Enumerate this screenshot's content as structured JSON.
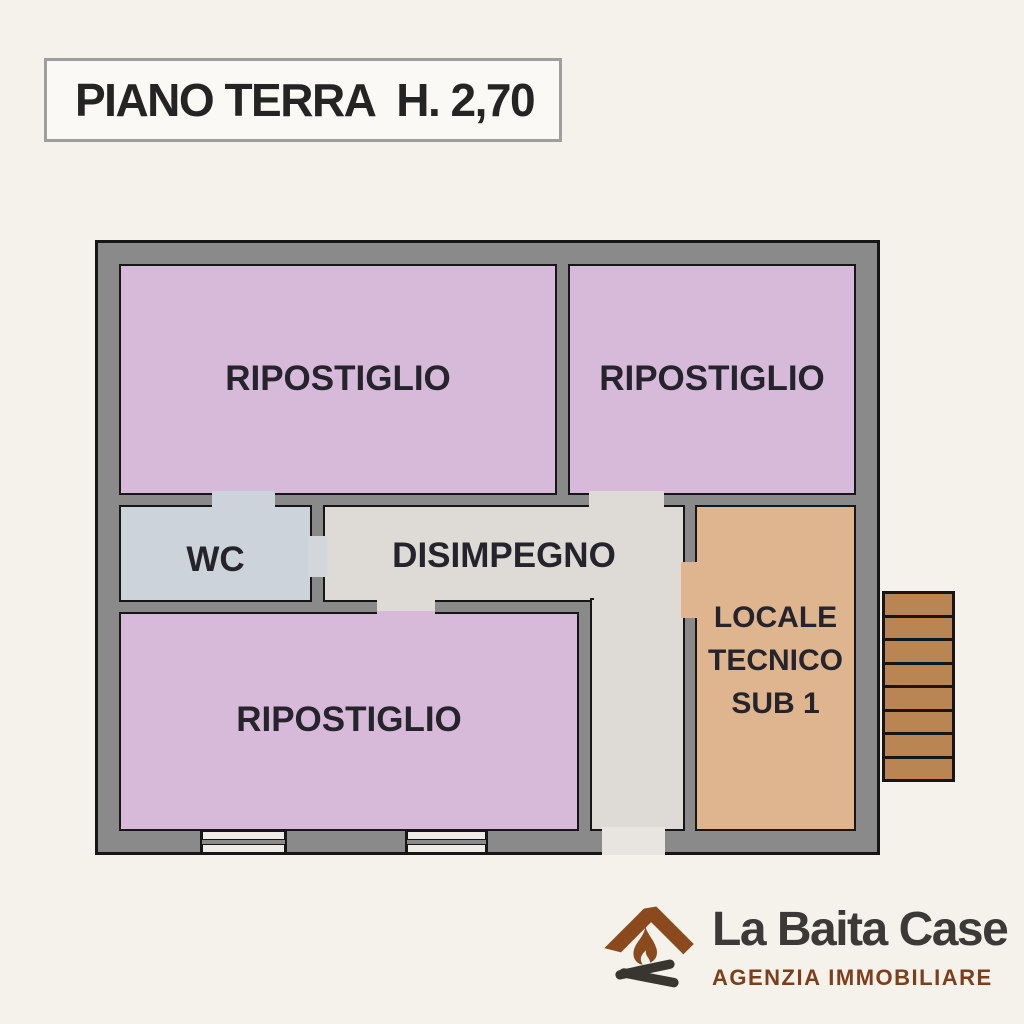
{
  "title": {
    "label": "PIANO TERRA  H. 2,70"
  },
  "rooms": {
    "storage_top_left": {
      "label": "RIPOSTIGLIO",
      "fill": "#d7b9da"
    },
    "storage_top_right": {
      "label": "RIPOSTIGLIO",
      "fill": "#d7b9da"
    },
    "wc": {
      "label": "WC",
      "fill": "#cdd3db"
    },
    "hallway": {
      "label": "DISIMPEGNO",
      "fill": "#dedad6"
    },
    "storage_bottom": {
      "label": "RIPOSTIGLIO",
      "fill": "#d7b9da"
    },
    "technical_room": {
      "label_line1": "LOCALE",
      "label_line2": "TECNICO",
      "label_line3": "SUB 1",
      "fill": "#deb58e"
    }
  },
  "stairs": {
    "steps": 8,
    "fill": "#b98553"
  },
  "logo": {
    "name": "La Baita Case",
    "tagline": "AGENZIA IMMOBILIARE"
  },
  "colors": {
    "background": "#f5f2ec",
    "wall_gray": "#8b8a8a",
    "wall_line_black": "#161616",
    "label_text": "#25242c",
    "logo_brown": "#8a4a1e",
    "logo_dark": "#3b3a38",
    "tagline_brown": "#7c3e1b"
  }
}
